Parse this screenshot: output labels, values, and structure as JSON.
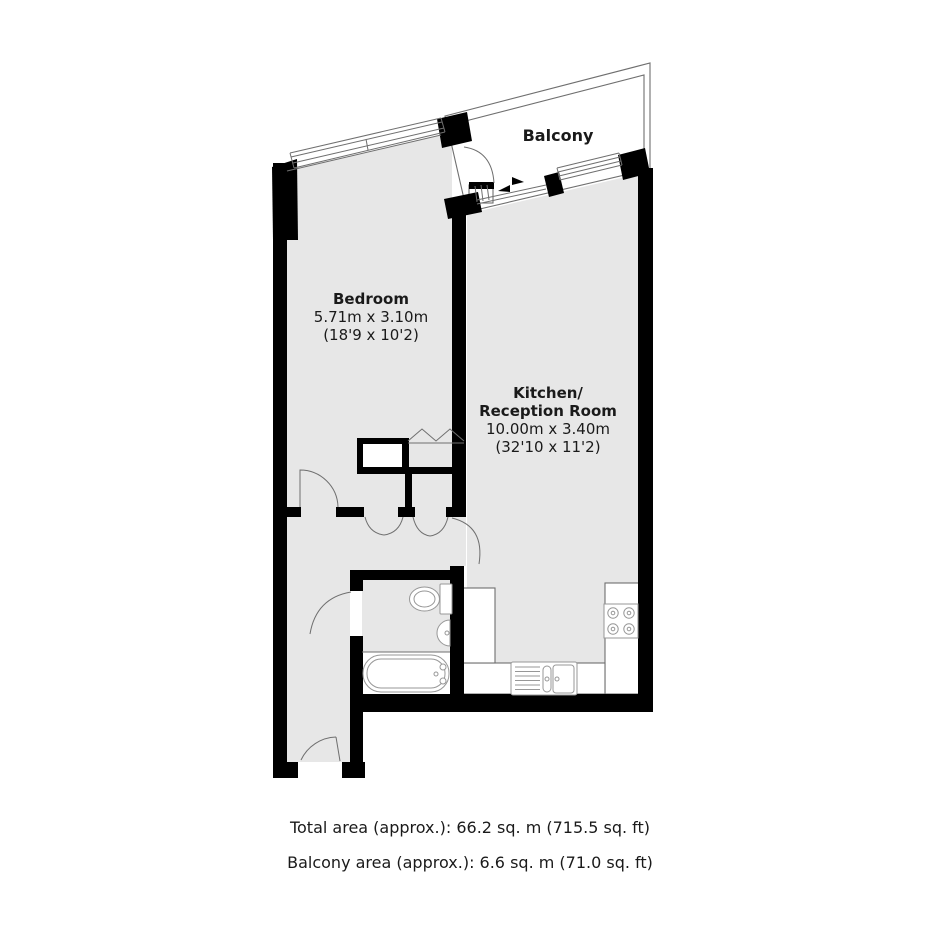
{
  "plan": {
    "balcony": {
      "label": "Balcony"
    },
    "bedroom": {
      "name": "Bedroom",
      "dims_metric": "5.71m x 3.10m",
      "dims_imperial": "(18'9 x 10'2)"
    },
    "kitchen": {
      "name_line1": "Kitchen/",
      "name_line2": "Reception Room",
      "dims_metric": "10.00m x 3.40m",
      "dims_imperial": "(32'10 x 11'2)"
    },
    "footer": {
      "total_area": "Total area (approx.): 66.2 sq. m (715.5 sq. ft)",
      "balcony_area": "Balcony area (approx.): 6.6 sq. m (71.0 sq. ft)"
    }
  },
  "colors": {
    "floor": "#e7e7e7",
    "wall": "#000000",
    "outline": "#6f6f6f",
    "fixture": "#979797",
    "text": "#1a1a1a",
    "paper": "#ffffff"
  }
}
